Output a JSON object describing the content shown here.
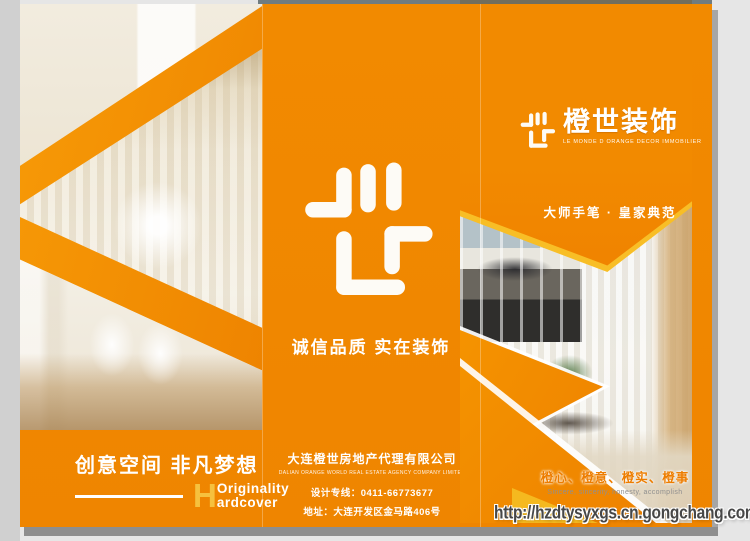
{
  "colors": {
    "orange": "#F28A00",
    "stripe_orange": "#F59300",
    "gold": "#F6B91F",
    "h_gold": "#F6C13E",
    "shadow_gray": "#8E8E8E"
  },
  "brand": {
    "title": "橙世装饰",
    "subtitle": "LE MONDE D ORANGE DECOR IMMOBILIER"
  },
  "center_panel": {
    "slogan": "诚信品质  实在装饰"
  },
  "right_panel": {
    "ribbon": "大师手笔 · 皇家典范",
    "values_cn": "橙心、橙意、橙实、橙事",
    "values_en": "Sincere, sincerity, honesty, accomplish"
  },
  "bottom_left": {
    "slogan": "创意空间  非凡梦想",
    "initial": "H",
    "word_top": "Originality",
    "word_bottom": "ardcover"
  },
  "company": {
    "name_cn": "大连橙世房地产代理有限公司",
    "name_en": "DALIAN ORANGE WORLD REAL ESTATE AGENCY COMPANY LIMITED",
    "design_hotline": "设计专线：0411-66773677",
    "address": "地址：大连开发区金马路406号"
  },
  "watermark": {
    "url": "http://hzdtysyxgs.cn.gongchang.com"
  }
}
